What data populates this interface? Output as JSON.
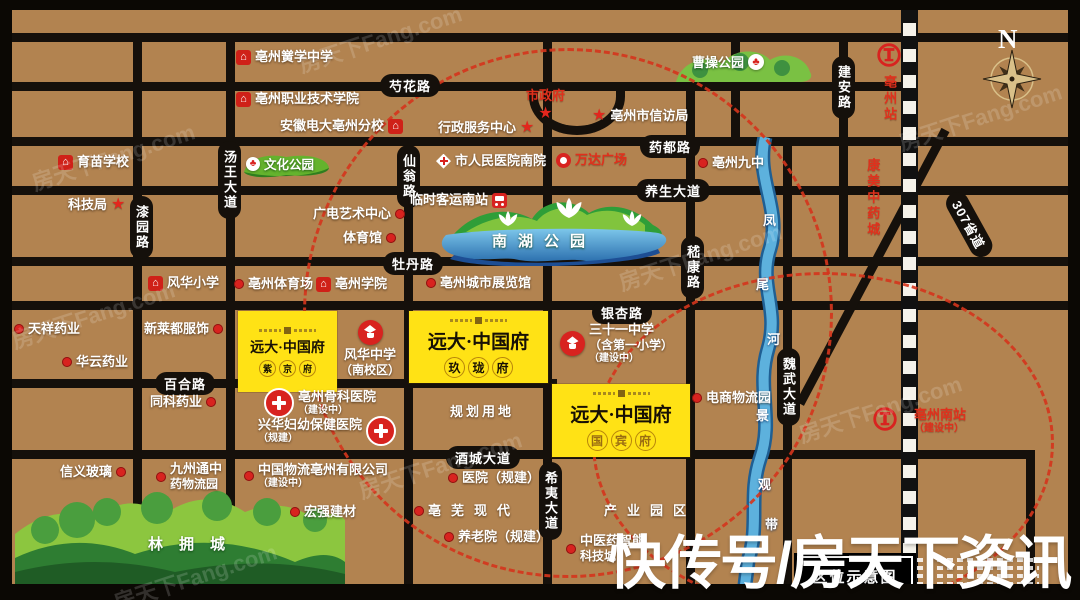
{
  "watermark": {
    "brand": "房天下Fang.com",
    "big": "快传号/房天下资讯"
  },
  "legend": {
    "label": "区位示意图"
  },
  "compass": {
    "label": "N"
  },
  "colors": {
    "background": "#b28350",
    "road": "#15100b",
    "accent_red": "#d8231f",
    "dashed_red": "#d5351c",
    "project_yellow": "#ffe215",
    "river_blue": "#4aa3d8",
    "park_green": "#5cb531"
  },
  "roads": [
    {
      "id": "shaohua",
      "name": "芍花路"
    },
    {
      "id": "yaodu",
      "name": "药都路"
    },
    {
      "id": "yangsheng",
      "name": "养生大道"
    },
    {
      "id": "mudan",
      "name": "牡丹路"
    },
    {
      "id": "yinxing",
      "name": "银杏路"
    },
    {
      "id": "baihe",
      "name": "百合路"
    },
    {
      "id": "jiucheng",
      "name": "酒城大道"
    },
    {
      "id": "tangwang",
      "name": "汤王大道"
    },
    {
      "id": "xianweng",
      "name": "仙翁路"
    },
    {
      "id": "qiyuan",
      "name": "漆园路"
    },
    {
      "id": "jikang",
      "name": "嵇康路"
    },
    {
      "id": "jianan",
      "name": "建安路"
    },
    {
      "id": "weiwu",
      "name": "魏武大道"
    },
    {
      "id": "xiyi",
      "name": "希夷大道"
    },
    {
      "id": "s307",
      "name": "307省道"
    }
  ],
  "pois": [
    {
      "id": "hongxue",
      "label": "亳州黉学中学"
    },
    {
      "id": "zhiye",
      "label": "亳州职业技术学院"
    },
    {
      "id": "dianda",
      "label": "安徽电大亳州分校"
    },
    {
      "id": "yumiao",
      "label": "育苗学校"
    },
    {
      "id": "keji",
      "label": "科技局"
    },
    {
      "id": "fenghuaxx",
      "label": "风华小学"
    },
    {
      "id": "tiyuchang",
      "label": "亳州体育场"
    },
    {
      "id": "bzxueyuan",
      "label": "亳州学院"
    },
    {
      "id": "tianxiang",
      "label": "天祥药业"
    },
    {
      "id": "huayun",
      "label": "华云药业"
    },
    {
      "id": "xinlaidou",
      "label": "新莱都服饰"
    },
    {
      "id": "tongke",
      "label": "同科药业"
    },
    {
      "id": "xinyi",
      "label": "信义玻璃"
    },
    {
      "id": "jiuzhoutong",
      "label": "九州通中",
      "sub": "药物流园"
    },
    {
      "id": "zgwuliu",
      "label": "中国物流亳州有限公司",
      "sub": "（建设中）"
    },
    {
      "id": "hongqiang",
      "label": "宏强建材"
    },
    {
      "id": "xingzheng",
      "label": "行政服务中心"
    },
    {
      "id": "shizhengfu",
      "label": "市政府"
    },
    {
      "id": "xinfang",
      "label": "亳州市信访局"
    },
    {
      "id": "renmin",
      "label": "市人民医院南院"
    },
    {
      "id": "wanda",
      "label": "万达广场"
    },
    {
      "id": "keyun",
      "label": "临时客运南站"
    },
    {
      "id": "guangdian",
      "label": "广电艺术中心"
    },
    {
      "id": "tiyuguan",
      "label": "体育馆"
    },
    {
      "id": "zhanlan",
      "label": "亳州城市展览馆"
    },
    {
      "id": "jiuzhong",
      "label": "亳州九中"
    },
    {
      "id": "kangmei",
      "label": "康美中药城"
    },
    {
      "id": "bzstation",
      "label": "亳州站"
    },
    {
      "id": "southstation",
      "label": "亳州南站",
      "sub": "（建设中）"
    },
    {
      "id": "school31",
      "label": "三十一中学",
      "sub": "（含第一小学）",
      "sub2": "（建设中）"
    },
    {
      "id": "fenghuamid",
      "label": "风华中学",
      "sub": "（南校区）"
    },
    {
      "id": "guke",
      "label": "亳州骨科医院",
      "sub": "（建设中）"
    },
    {
      "id": "fuyou",
      "label": "兴华妇幼保健医院",
      "sub": "（规建）"
    },
    {
      "id": "guihua",
      "label": "规划用地"
    },
    {
      "id": "yiyuan",
      "label": "医院（规建）"
    },
    {
      "id": "yanglao",
      "label": "养老院（规建）"
    },
    {
      "id": "bowuwest",
      "label": "亳芜现代"
    },
    {
      "id": "bowueast",
      "label": "产业园区"
    },
    {
      "id": "tcm",
      "label": "中医药智能",
      "sub": "科技城"
    },
    {
      "id": "dianshang",
      "label": "电商物流园"
    }
  ],
  "projects": [
    {
      "id": "zijing",
      "brand": "远大·中国府",
      "name": "紫京府"
    },
    {
      "id": "jiulong",
      "brand": "远大·中国府",
      "name": "玖珑府"
    },
    {
      "id": "guobin",
      "brand": "远大·中国府",
      "name": "国宾府"
    }
  ],
  "parks": [
    {
      "id": "wenhua",
      "name": "文化公园"
    },
    {
      "id": "caocao",
      "name": "曹操公园"
    },
    {
      "id": "nanhu",
      "name": "南湖公园"
    },
    {
      "id": "linyong",
      "name": "林拥城"
    }
  ],
  "river": {
    "name": "凤尾河",
    "belt": "景观带"
  }
}
